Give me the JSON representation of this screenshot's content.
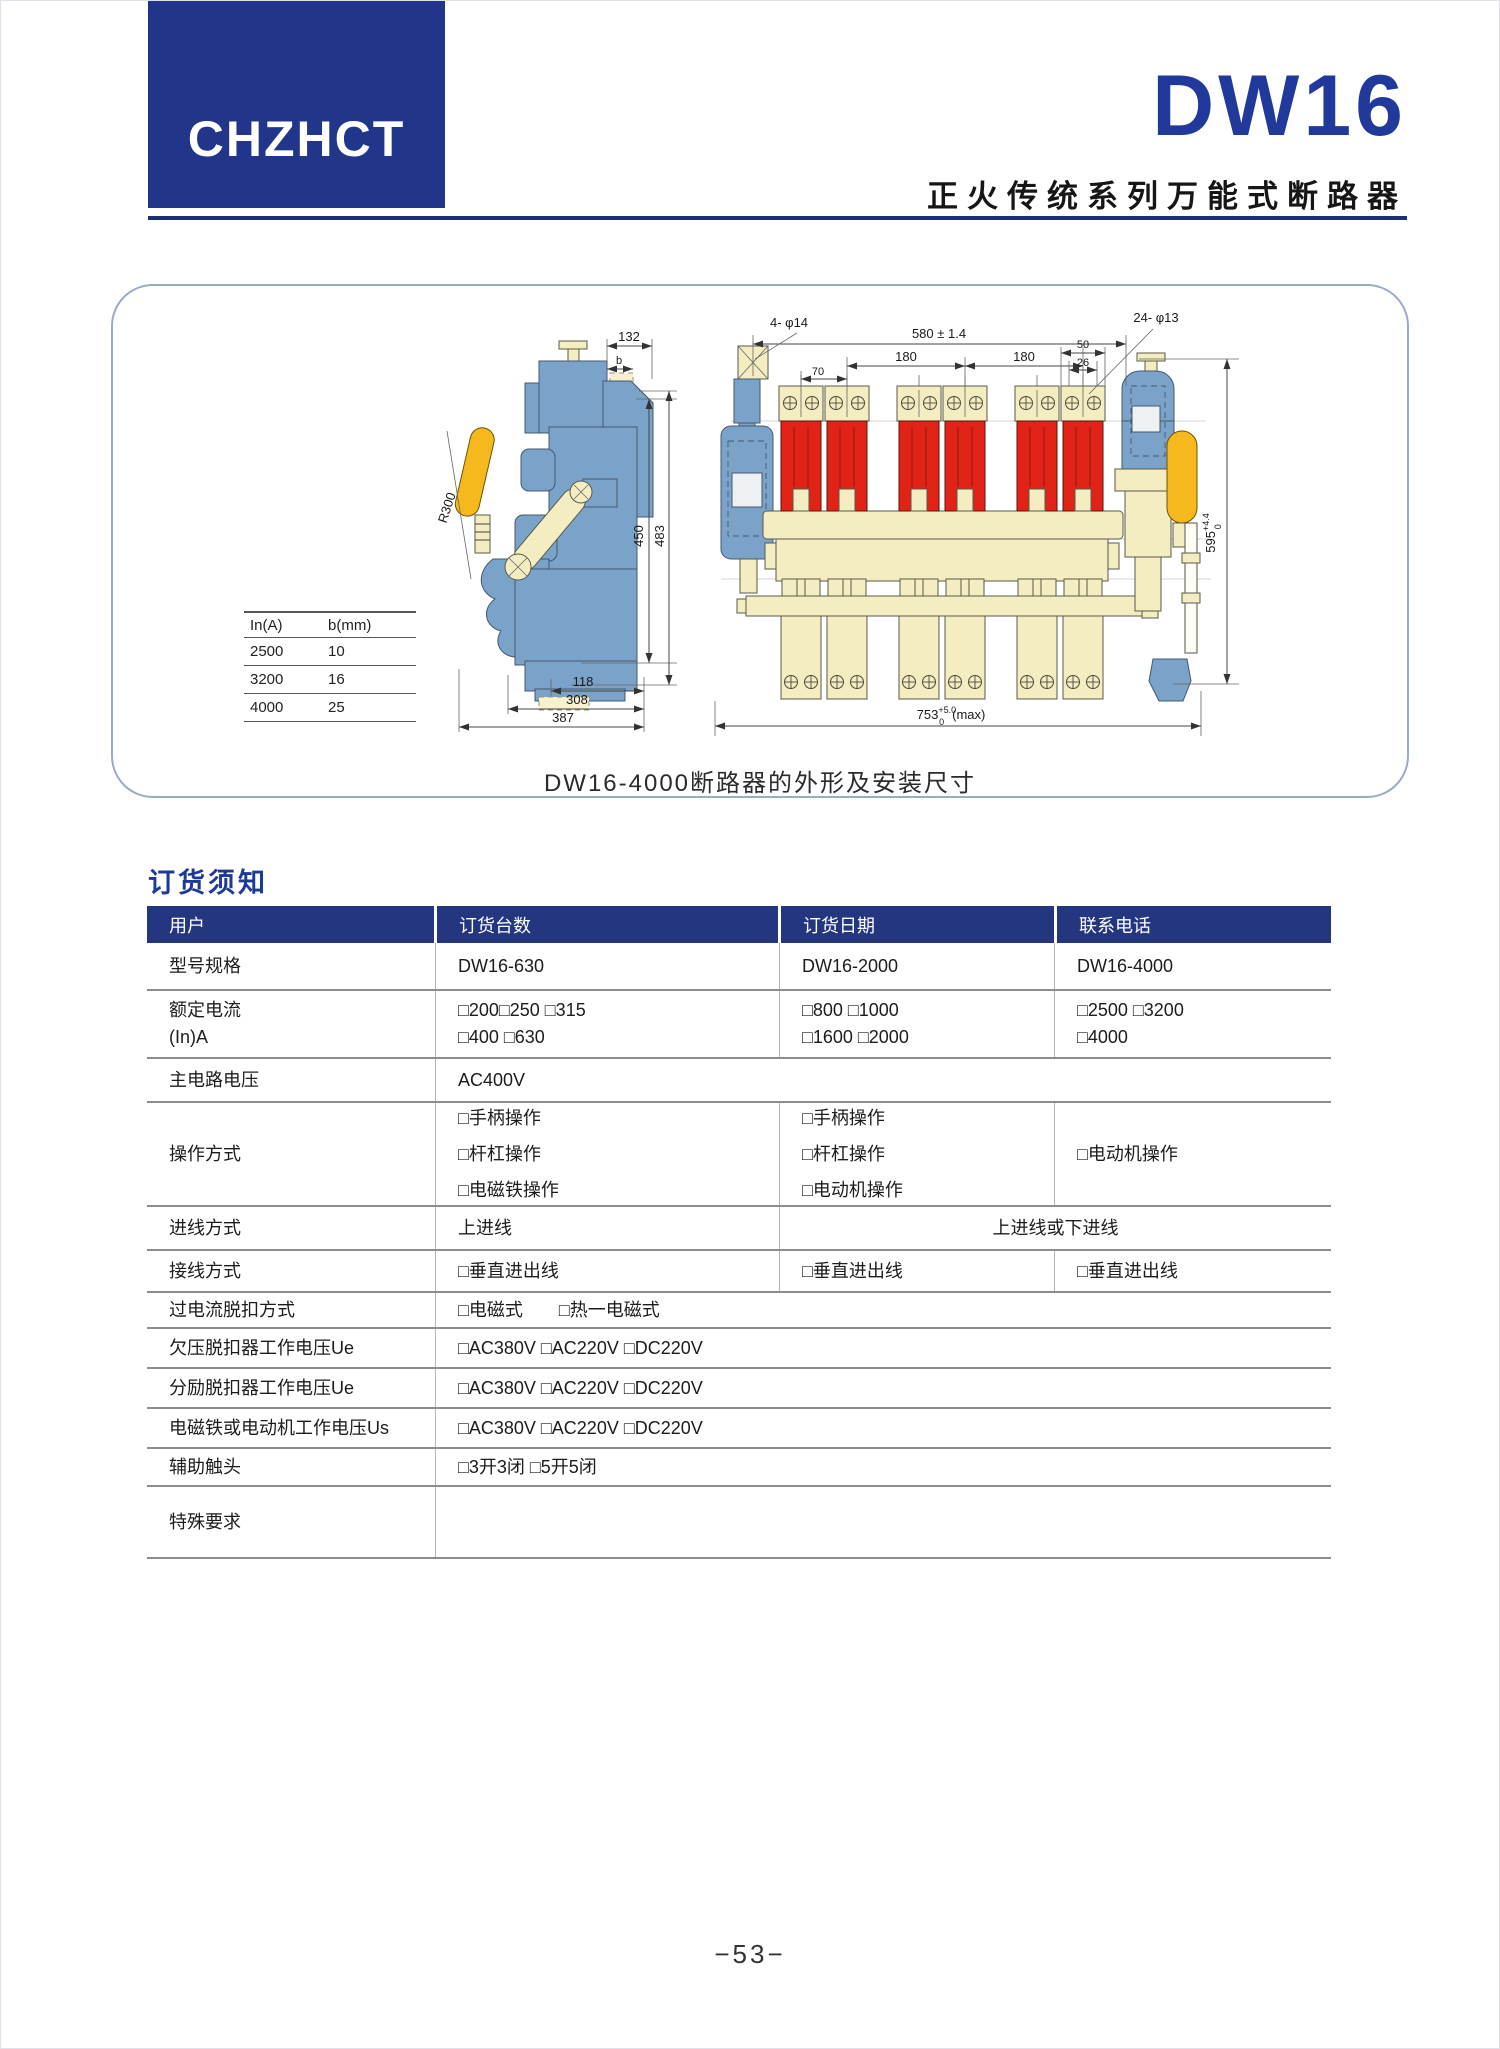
{
  "page": {
    "footer_page_number": "−53−"
  },
  "header": {
    "logo_text": "CHZHCT",
    "model": "DW16",
    "subtitle": "正火传统系列万能式断路器",
    "brand_blue": "#21368b"
  },
  "figure": {
    "caption": "DW16-4000断路器的外形及安装尺寸",
    "colors": {
      "steel_blue": "#7ba3c9",
      "cream": "#f4edc2",
      "red": "#e02316",
      "yellow": "#f5b91e"
    },
    "size_table": {
      "col1_header": "In(A)",
      "col2_header": "b(mm)",
      "rows": [
        [
          "2500",
          "10"
        ],
        [
          "3200",
          "16"
        ],
        [
          "4000",
          "25"
        ]
      ]
    },
    "left": {
      "d132": "132",
      "db": "b",
      "d450": "450",
      "d483": "483",
      "r300": "R300",
      "d118": "118",
      "d308": "308",
      "d387": "387"
    },
    "front": {
      "d580": "580 ± 1.4",
      "d4p14": "4- φ14",
      "d24p13": "24- φ13",
      "d180a": "180",
      "d180b": "180",
      "d50": "50",
      "d26": "26",
      "d70": "70",
      "d595": "595",
      "d595sup": "+4.4",
      "d595sub": "0",
      "d753": "753",
      "d753sup": "+5.0",
      "d753sub": "0",
      "d753max": "(max)"
    }
  },
  "order": {
    "section_title": "订货须知",
    "headers": [
      "用户",
      "订货台数",
      "订货日期",
      "联系电话"
    ],
    "rows": {
      "model": {
        "label": "型号规格",
        "c1": "DW16-630",
        "c2": "DW16-2000",
        "c3": "DW16-4000"
      },
      "current": {
        "label": "额定电流",
        "label2": "(In)A",
        "c1a": "□200□250 □315",
        "c1b": "□400 □630",
        "c2a": "□800 □1000",
        "c2b": "□1600 □2000",
        "c3a": "□2500 □3200",
        "c3b": "□4000"
      },
      "voltage": {
        "label": "主电路电压",
        "value": "AC400V"
      },
      "operation": {
        "label": "操作方式",
        "c1a": "□手柄操作",
        "c1b": "□杆杠操作",
        "c1c": "□电磁铁操作",
        "c2a": "□手柄操作",
        "c2b": "□杆杠操作",
        "c2c": "□电动机操作",
        "c3": "□电动机操作"
      },
      "inlet": {
        "label": "进线方式",
        "c1": "上进线",
        "c2": "上进线或下进线"
      },
      "wiring": {
        "label": "接线方式",
        "c1": "□垂直进出线",
        "c2": "□垂直进出线",
        "c3": "□垂直进出线"
      },
      "overcurrent": {
        "label": "过电流脱扣方式",
        "value": "□电磁式　　□热一电磁式"
      },
      "undervolt": {
        "label": "欠压脱扣器工作电压Ue",
        "value": "□AC380V □AC220V □DC220V"
      },
      "shunt": {
        "label": "分励脱扣器工作电压Ue",
        "value": "□AC380V □AC220V □DC220V"
      },
      "solenoid": {
        "label": "电磁铁或电动机工作电压Us",
        "value": "□AC380V □AC220V □DC220V"
      },
      "aux": {
        "label": "辅助触头",
        "value": "□3开3闭 □5开5闭"
      },
      "special": {
        "label": "特殊要求",
        "value": ""
      }
    }
  }
}
